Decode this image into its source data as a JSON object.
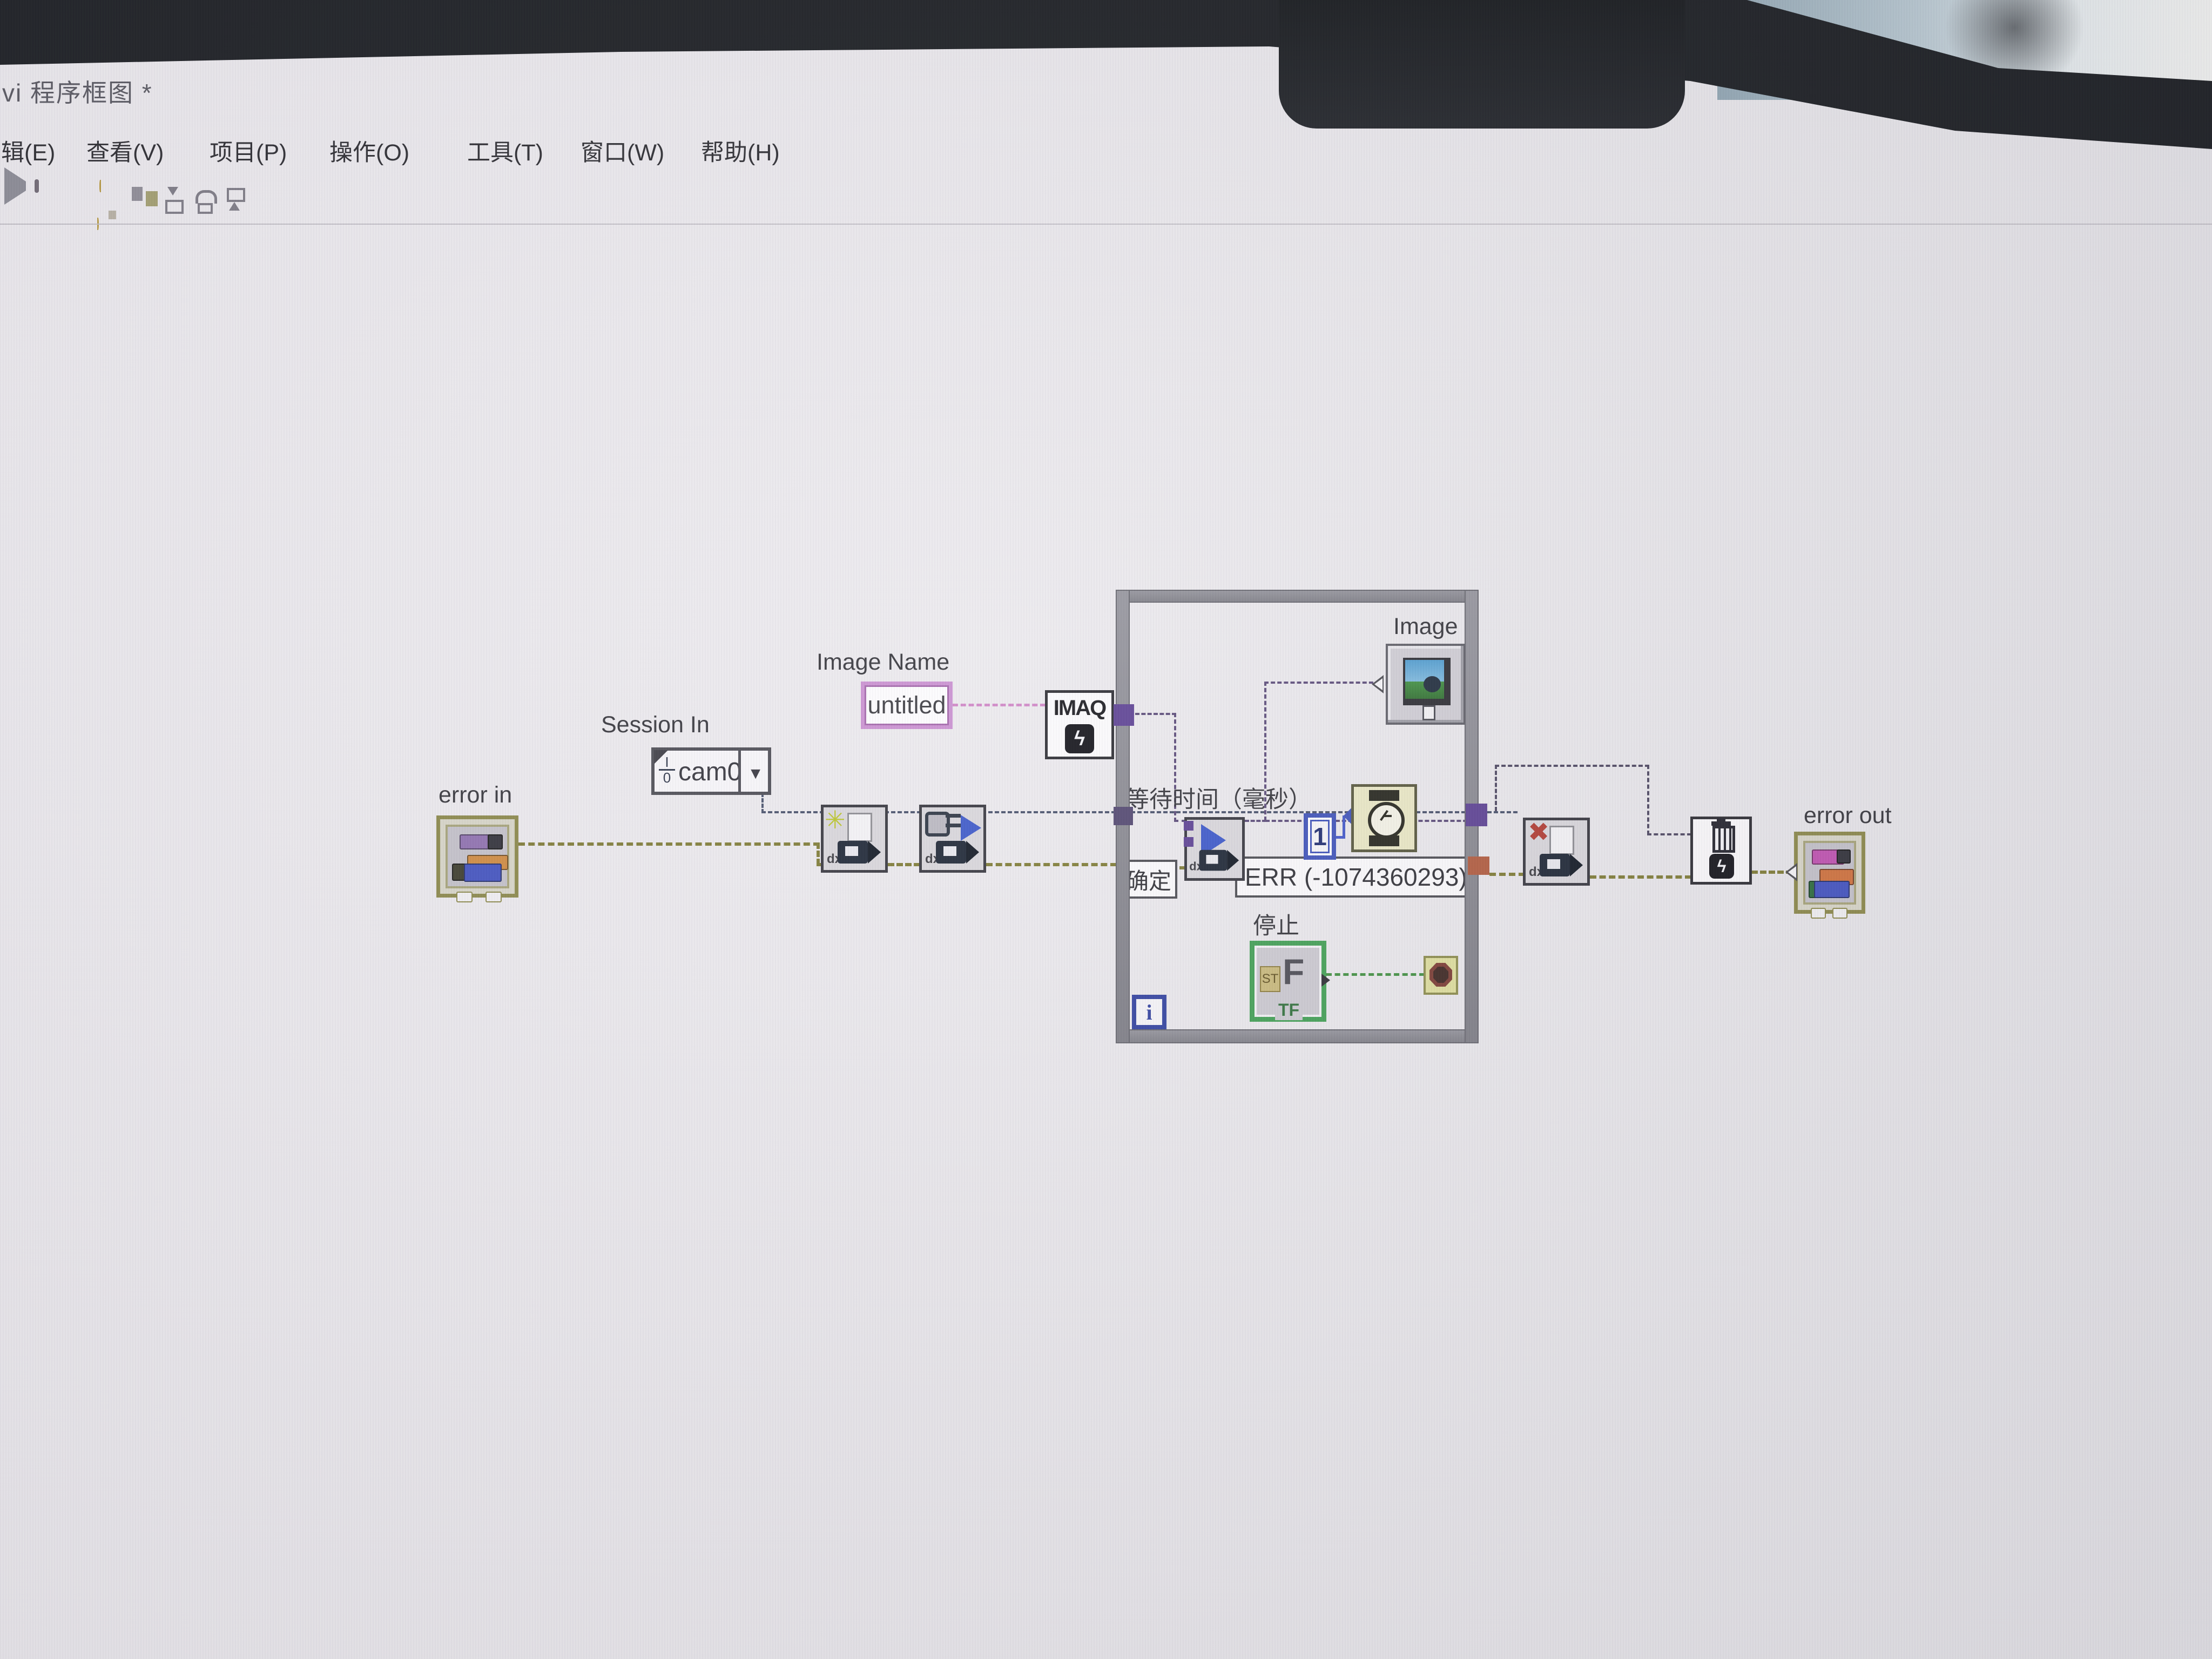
{
  "window": {
    "title": "vi 程序框图 *"
  },
  "menu": {
    "items": [
      {
        "label": "辑(E)"
      },
      {
        "label": "查看(V)"
      },
      {
        "label": "项目(P)"
      },
      {
        "label": "操作(O)"
      },
      {
        "label": "工具(T)"
      },
      {
        "label": "窗口(W)"
      },
      {
        "label": "帮助(H)"
      }
    ]
  },
  "toolbar": {
    "icons": [
      "run",
      "abort",
      "pause",
      "highlight-execution",
      "retain-wire-values",
      "step-into",
      "step-over",
      "step-out"
    ]
  },
  "diagram": {
    "error_in": {
      "label": "error in"
    },
    "session_in": {
      "label": "Session In",
      "value": "cam0",
      "io_top": "I",
      "io_bottom": "0",
      "dropdown_glyph": "▼"
    },
    "image_name": {
      "label": "Image Name",
      "value": "untitled"
    },
    "imaq_create": {
      "title": "IMAQ",
      "logo_glyph": "ϟ"
    },
    "open_camera": {
      "burst_glyph": "✳",
      "dx_text": "dx"
    },
    "configure_grab": {
      "dx_text": "dx"
    },
    "grab": {
      "dx_text": "dx"
    },
    "close_camera": {
      "x_glyph": "✖",
      "dx_text": "dx"
    },
    "dispose": {
      "logo_glyph": "ϟ"
    },
    "wait_time": {
      "label": "等待时间（毫秒）",
      "constant_value": "1"
    },
    "confirm": {
      "label": "确定"
    },
    "error_constant": {
      "text": "ERR (-1074360293)"
    },
    "stop": {
      "label": "停止",
      "side_text": "ST",
      "big_text": "F",
      "type_text": "TF"
    },
    "loop": {
      "iteration_glyph": "i"
    },
    "image_indicator": {
      "label": "Image"
    },
    "error_out": {
      "label": "error out"
    }
  }
}
